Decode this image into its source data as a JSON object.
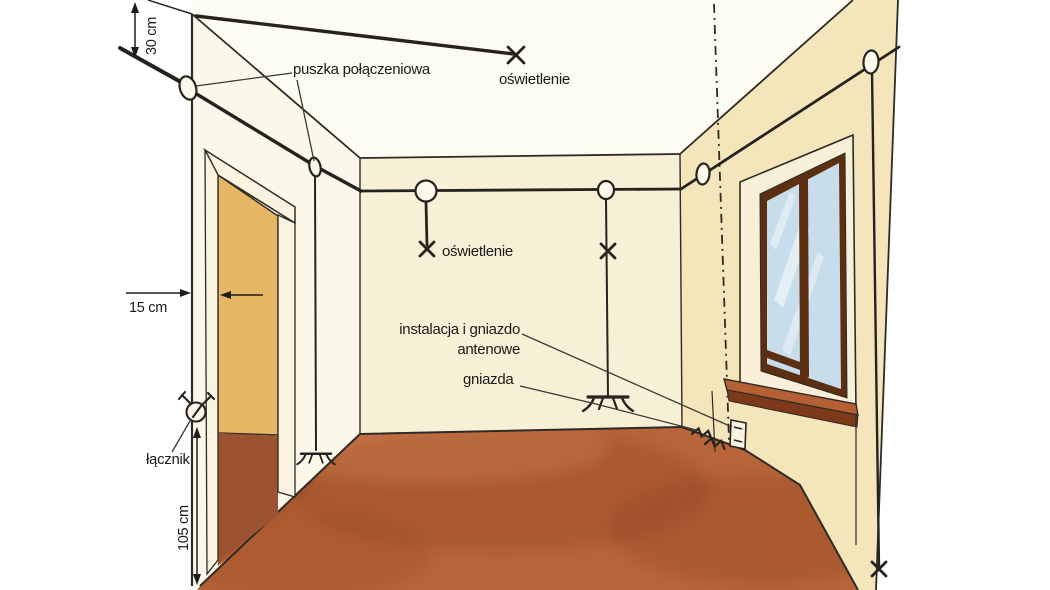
{
  "illustration": {
    "labels": {
      "junction_box": "puszka połączeniowa",
      "ceiling_light": "oświetlenie",
      "wall_light": "oświetlenie",
      "antenna_line1": "instalacja i gniazdo",
      "antenna_line2": "antenowe",
      "sockets": "gniazda",
      "switch": "łącznik"
    },
    "dimensions": {
      "wire_below_ceiling": "30 cm",
      "switch_from_door": "15 cm",
      "switch_height": "105 cm"
    },
    "symbols": [
      {
        "name": "junction-box",
        "count": 6
      },
      {
        "name": "ceiling-light-point",
        "count": 1
      },
      {
        "name": "wall-light-point",
        "count": 2
      },
      {
        "name": "switch",
        "count": 1
      },
      {
        "name": "wall-socket",
        "count": 3
      },
      {
        "name": "antenna-socket",
        "count": 1
      }
    ],
    "colors": {
      "ceiling": "#fdfcf3",
      "wall_left": "#fbf7e9",
      "wall_back": "#f8f0d6",
      "wall_right": "#f4e5bb",
      "door_frame": "#faf3df",
      "door_opening": "#e5b765",
      "door_floor": "#9c5130",
      "floor": "#b9653a",
      "window_reveal": "#f8efd8",
      "window_frame": "#5d2f12",
      "window_glass": "#c7ddeb",
      "window_sill": "#b55f35",
      "sill_front": "#7c3a1a",
      "line": "#2e2b26"
    }
  }
}
